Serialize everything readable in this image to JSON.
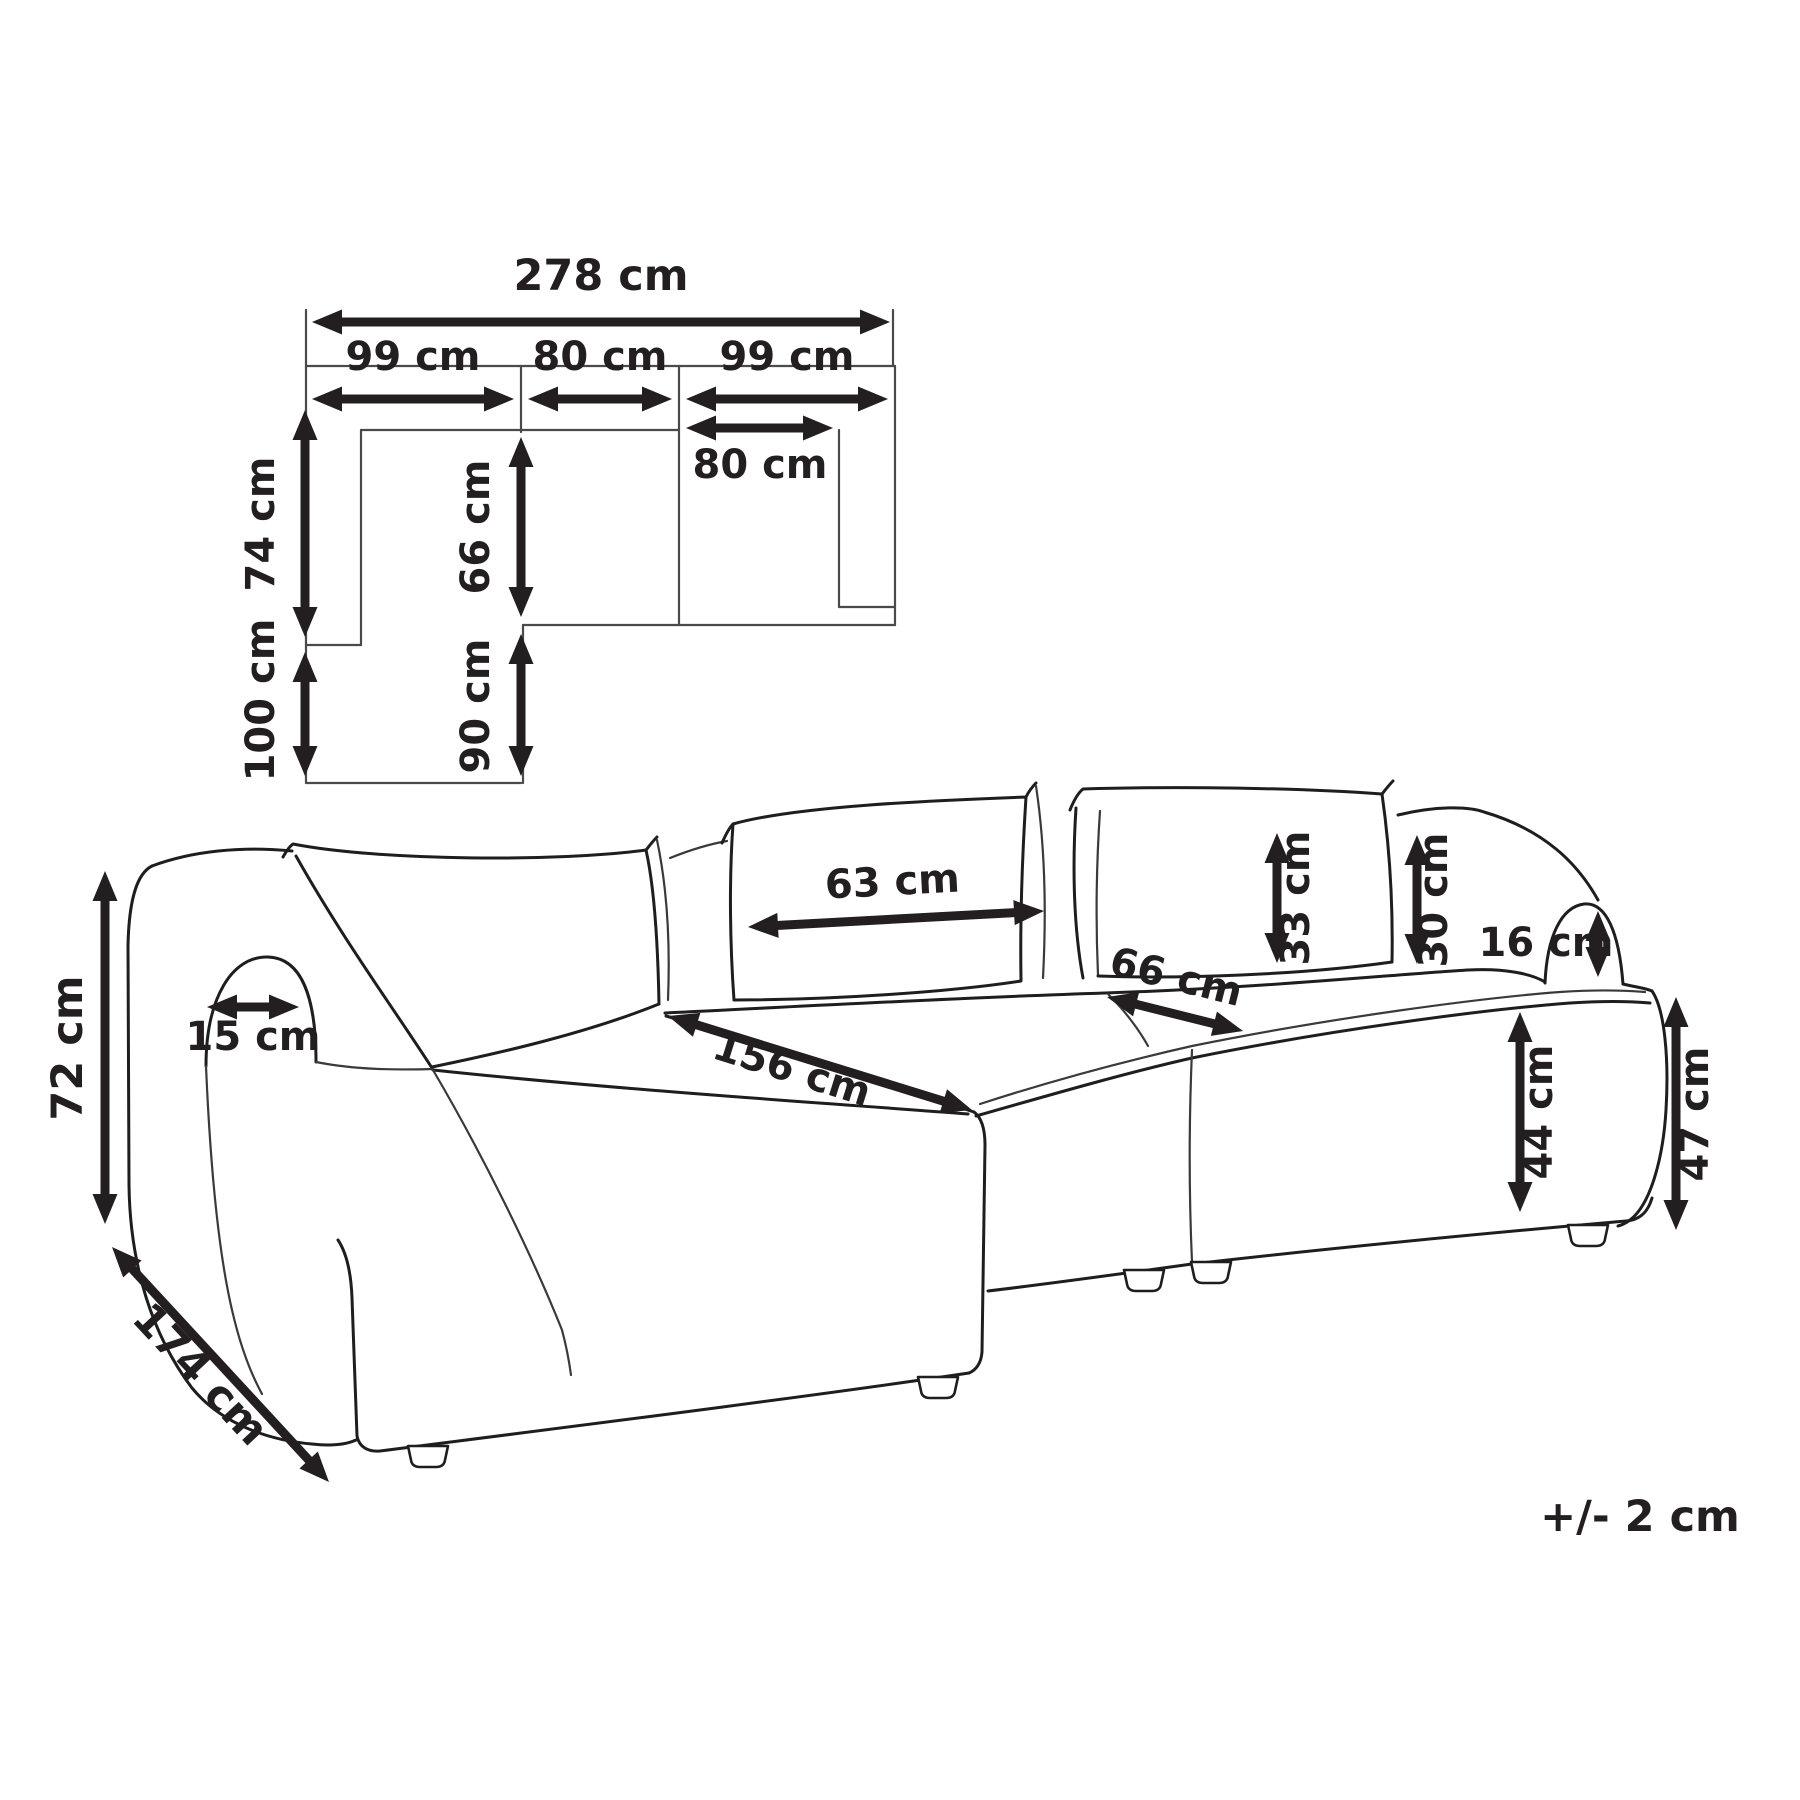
{
  "plan_view": {
    "overall_width": "278 cm",
    "left_section_width": "99 cm",
    "middle_section_width": "80 cm",
    "right_section_width": "99 cm",
    "back_depth": "74 cm",
    "chaise_extension": "100 cm",
    "seat_depth": "66 cm",
    "chaise_inner_length": "90 cm",
    "right_seat_inner_width": "80 cm"
  },
  "sofa_view": {
    "total_height": "72 cm",
    "total_depth": "174 cm",
    "armrest_inner_width": "15 cm",
    "back_cushion_width": "63 cm",
    "chaise_length": "156 cm",
    "seat_width": "66 cm",
    "back_cushion_height": "33 cm",
    "backrest_height": "30 cm",
    "armrest_height": "16 cm",
    "seat_height": "44 cm",
    "arm_side_height": "47 cm"
  },
  "note": {
    "tolerance": "+/- 2 cm"
  }
}
